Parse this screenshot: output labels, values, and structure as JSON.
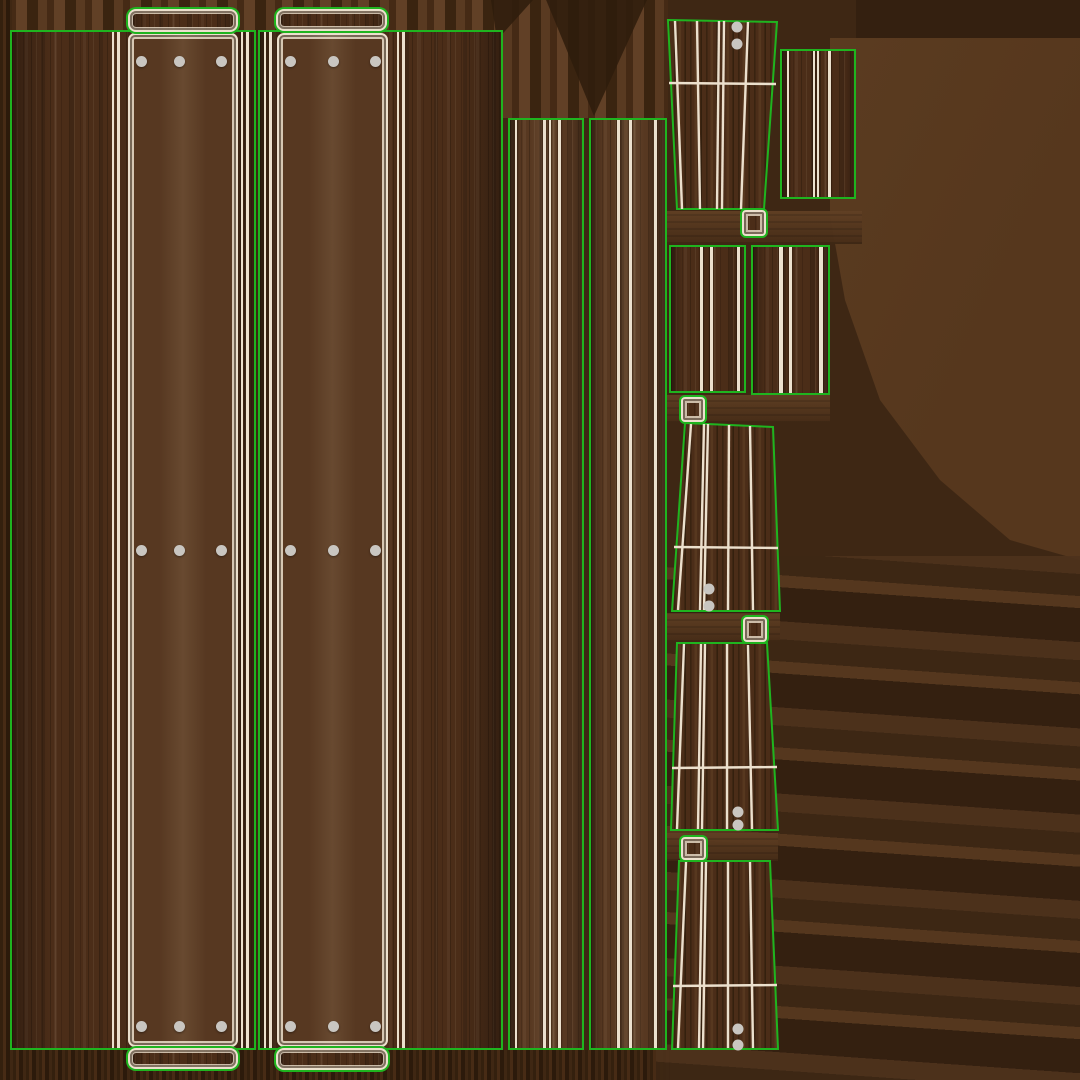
{
  "atlas": {
    "type": "uv_texture_atlas",
    "subject": "wooden picnic-table / bench texture with UV island outlines",
    "canvas_size": "1080x1080",
    "islands": [
      {
        "name": "tabletop-panel-left",
        "shape": "rectangle",
        "bolts": 9,
        "tabs": 2
      },
      {
        "name": "tabletop-panel-right",
        "shape": "rectangle",
        "bolts": 9,
        "tabs": 2
      },
      {
        "name": "plank-strip-narrow",
        "shape": "rectangle",
        "bolts": 0
      },
      {
        "name": "plank-strip-wide",
        "shape": "rectangle",
        "bolts": 0
      },
      {
        "name": "leg-top",
        "shape": "trapezoid",
        "bolts": 2
      },
      {
        "name": "side-panel",
        "shape": "rectangle",
        "bolts": 0
      },
      {
        "name": "brace-left",
        "shape": "rectangle",
        "bolts": 0
      },
      {
        "name": "brace-right",
        "shape": "rectangle",
        "bolts": 0
      },
      {
        "name": "leg-mid",
        "shape": "trapezoid",
        "bolts": 2
      },
      {
        "name": "leg-lower",
        "shape": "trapezoid",
        "bolts": 2
      },
      {
        "name": "leg-bottom",
        "shape": "trapezoid",
        "bolts": 2
      },
      {
        "name": "cap-square",
        "shape": "square",
        "count": 4
      }
    ]
  },
  "palette": {
    "green": "#1fb41f",
    "seam": "#ece0cd",
    "dot": "#c9c6c1",
    "wood-base": "#4b2d18",
    "wood-light": "#573821",
    "wood-dark": "#3a2411",
    "bg-base": "#3e2714",
    "bg-light": "#5c3d21",
    "bg-dark": "#2e1c0c"
  }
}
